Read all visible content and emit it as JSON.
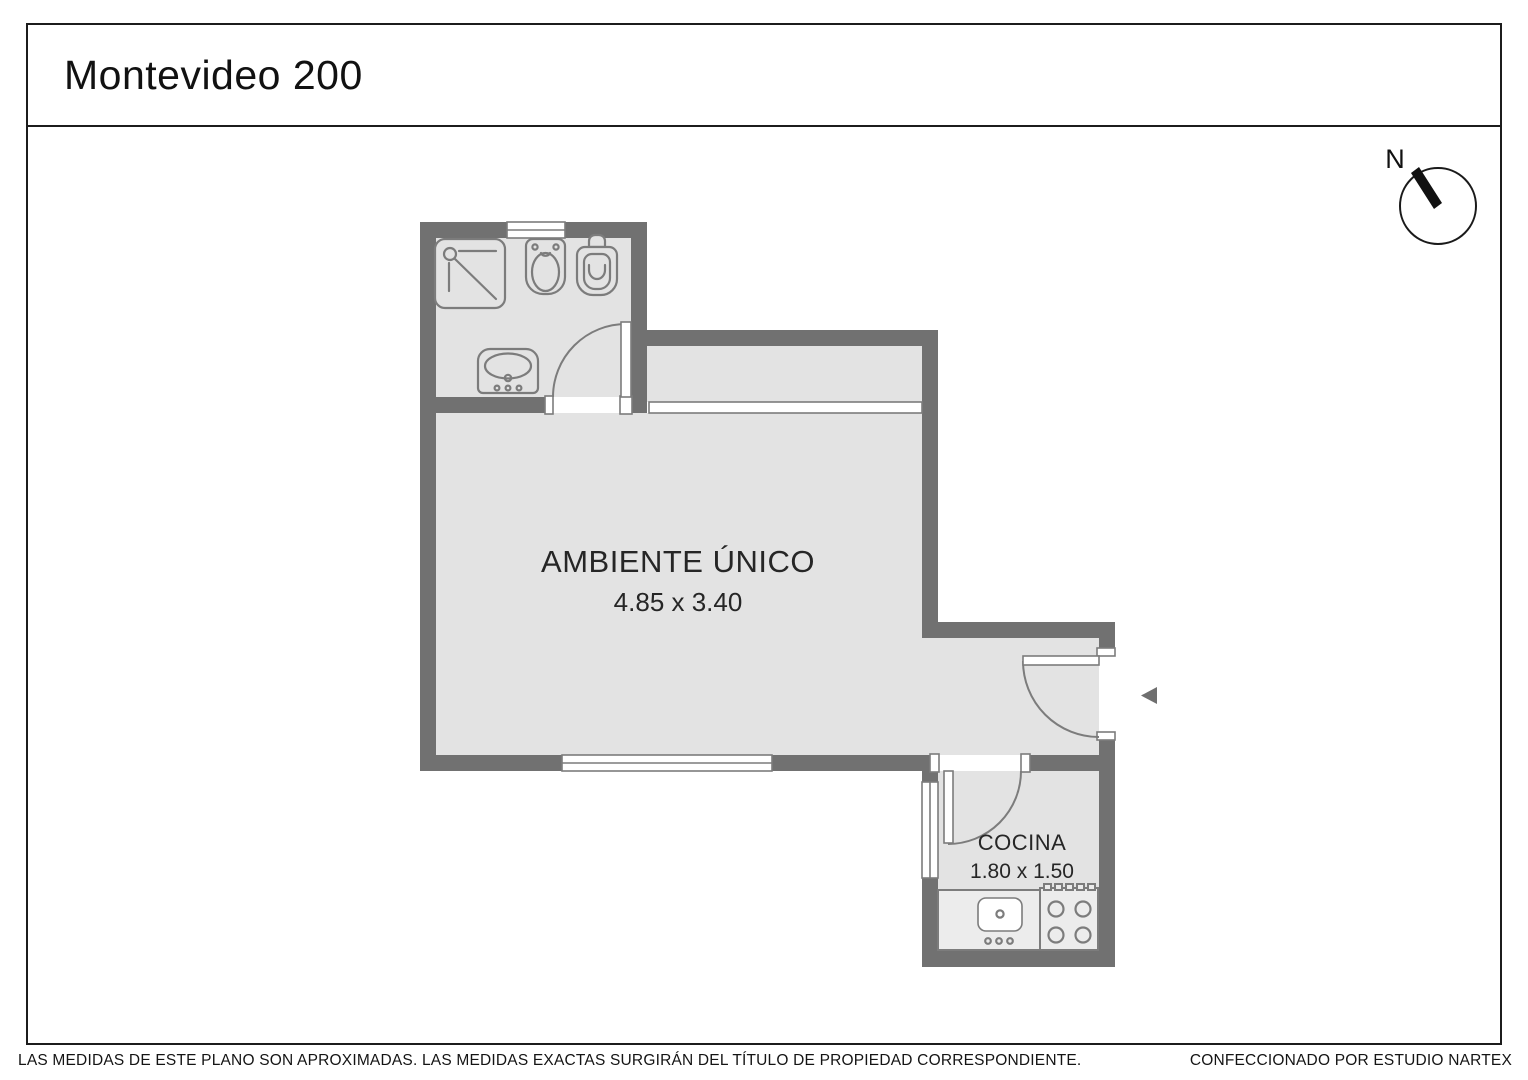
{
  "title": "Montevideo 200",
  "compass": {
    "north_label": "N"
  },
  "plan": {
    "main_room": {
      "name": "AMBIENTE ÚNICO",
      "dimensions": "4.85 x 3.40"
    },
    "kitchen": {
      "name": "COCINA",
      "dimensions": "1.80 x 1.50"
    },
    "fixtures": [
      "shower",
      "bidet",
      "toilet",
      "bathroom-sink",
      "kitchen-sink",
      "stove"
    ],
    "entrance_marker": "left-pointing-arrow"
  },
  "footer": {
    "left": "LAS MEDIDAS  DE ESTE PLANO SON APROXIMADAS. LAS MEDIDAS EXACTAS SURGIRÁN DEL TÍTULO DE PROPIEDAD CORRESPONDIENTE.",
    "right": "CONFECCIONADO POR ESTUDIO NARTEX"
  },
  "colors": {
    "wall": "#717171",
    "floor": "#e3e3e3",
    "fixture_outline": "#7c7c7c",
    "frame_line": "#1c1c1c",
    "text": "#262626",
    "background": "#ffffff"
  }
}
